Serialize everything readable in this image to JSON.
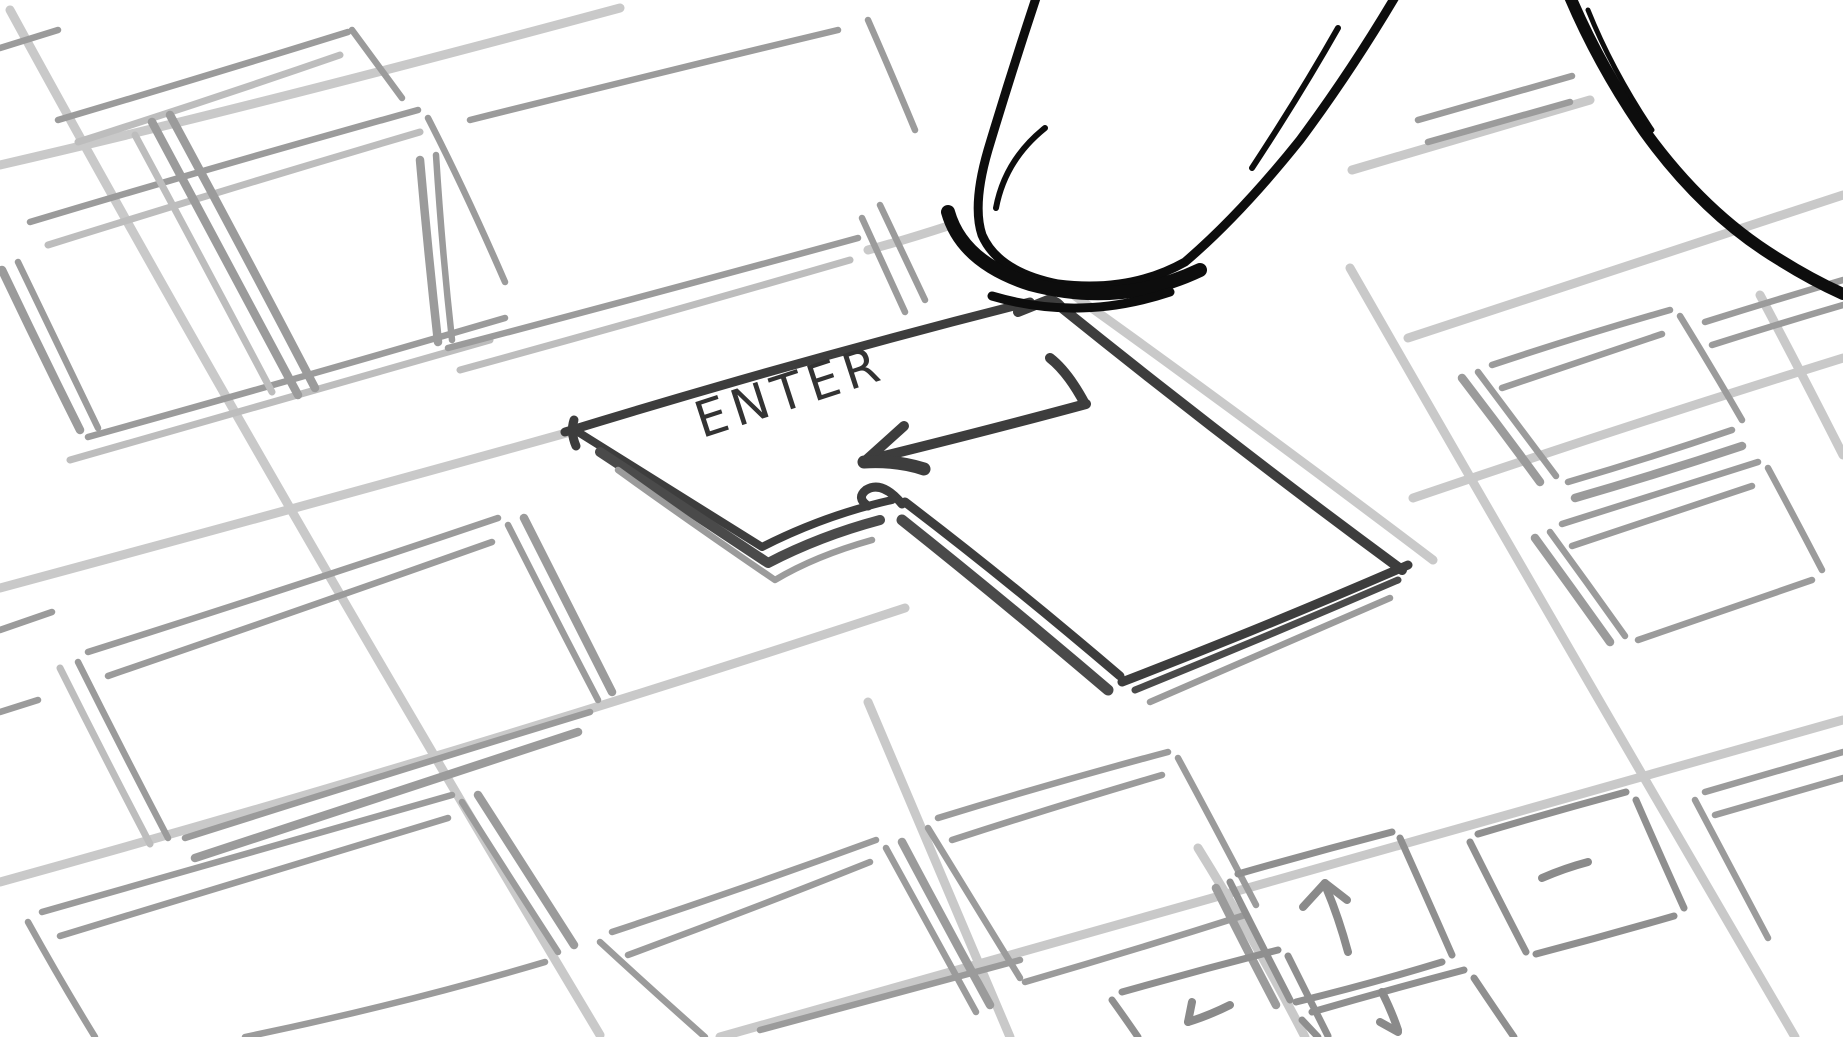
{
  "illustration": {
    "description": "Hand-drawn cartoon of a fingertip about to press the ENTER key of a keyboard",
    "enter_key": {
      "label": "ENTER",
      "symbol_icon": "return-arrow-icon",
      "fill_color": "#c9c9c9",
      "outline_color": "#3d3d3d",
      "label_color": "#333333"
    },
    "finger": {
      "fill_color": "#929292",
      "outline_color": "#0d0d0d"
    },
    "hand": {
      "fill_color": "#929292",
      "outline_color": "#0d0d0d"
    },
    "keyboard": {
      "background_color": "#ffffff",
      "gutter_line_color": "#c9c9c9",
      "key_sketch_color": "#9b9b9b",
      "arrow_cluster": {
        "up_icon": "up-arrow-icon",
        "down_icon": "down-arrow-icon",
        "left_icon": "left-arrow-icon",
        "dash_icon": "dash-icon"
      }
    }
  }
}
